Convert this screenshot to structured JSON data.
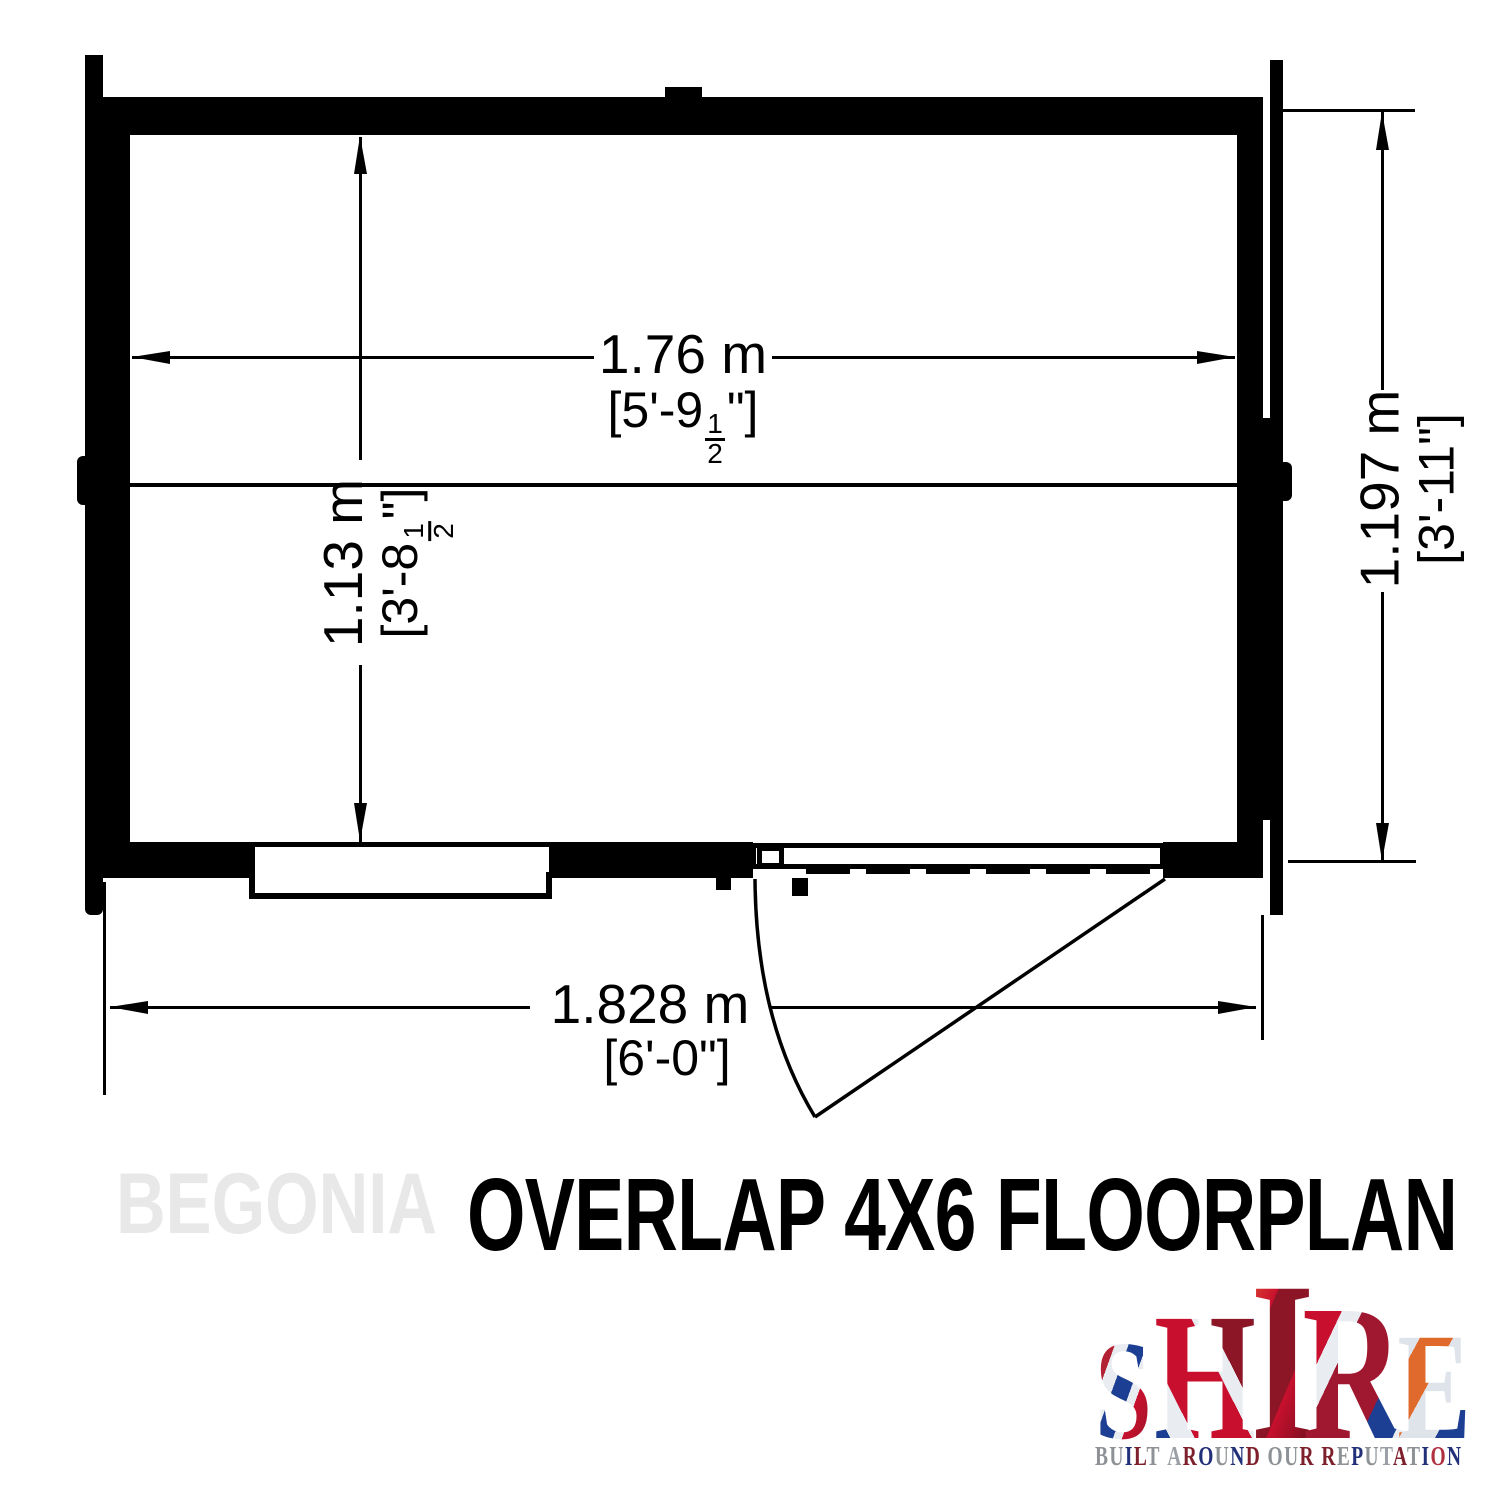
{
  "title": "OVERLAP 4X6 FLOORPLAN",
  "watermark": "BEGONIA",
  "dimensions": {
    "interior_width": {
      "metric": "1.76 m",
      "imperial_prefix": "[5'-9",
      "fraction_numerator": "1",
      "fraction_denominator": "2",
      "imperial_suffix": "\"]"
    },
    "interior_depth": {
      "metric": "1.13 m",
      "imperial_prefix": "[3'-8",
      "fraction_numerator": "1",
      "fraction_denominator": "2",
      "imperial_suffix": "\"]"
    },
    "side_depth": {
      "metric": "1.197 m",
      "imperial": "[3'-11\"]"
    },
    "overall_width": {
      "metric": "1.828 m",
      "imperial": "[6'-0\"]"
    }
  },
  "logo": {
    "letters": [
      "S",
      "H",
      "I",
      "R",
      "E"
    ],
    "tagline": "BUILT AROUND OUR REPUTATION"
  },
  "colors": {
    "ink": "#000000",
    "watermark_gray": "#e8e8e8",
    "flag_red": "#c8102e",
    "flag_dark_red": "#8c1626",
    "flag_blue": "#1c3f94",
    "flag_silver": "#e9edf2"
  }
}
